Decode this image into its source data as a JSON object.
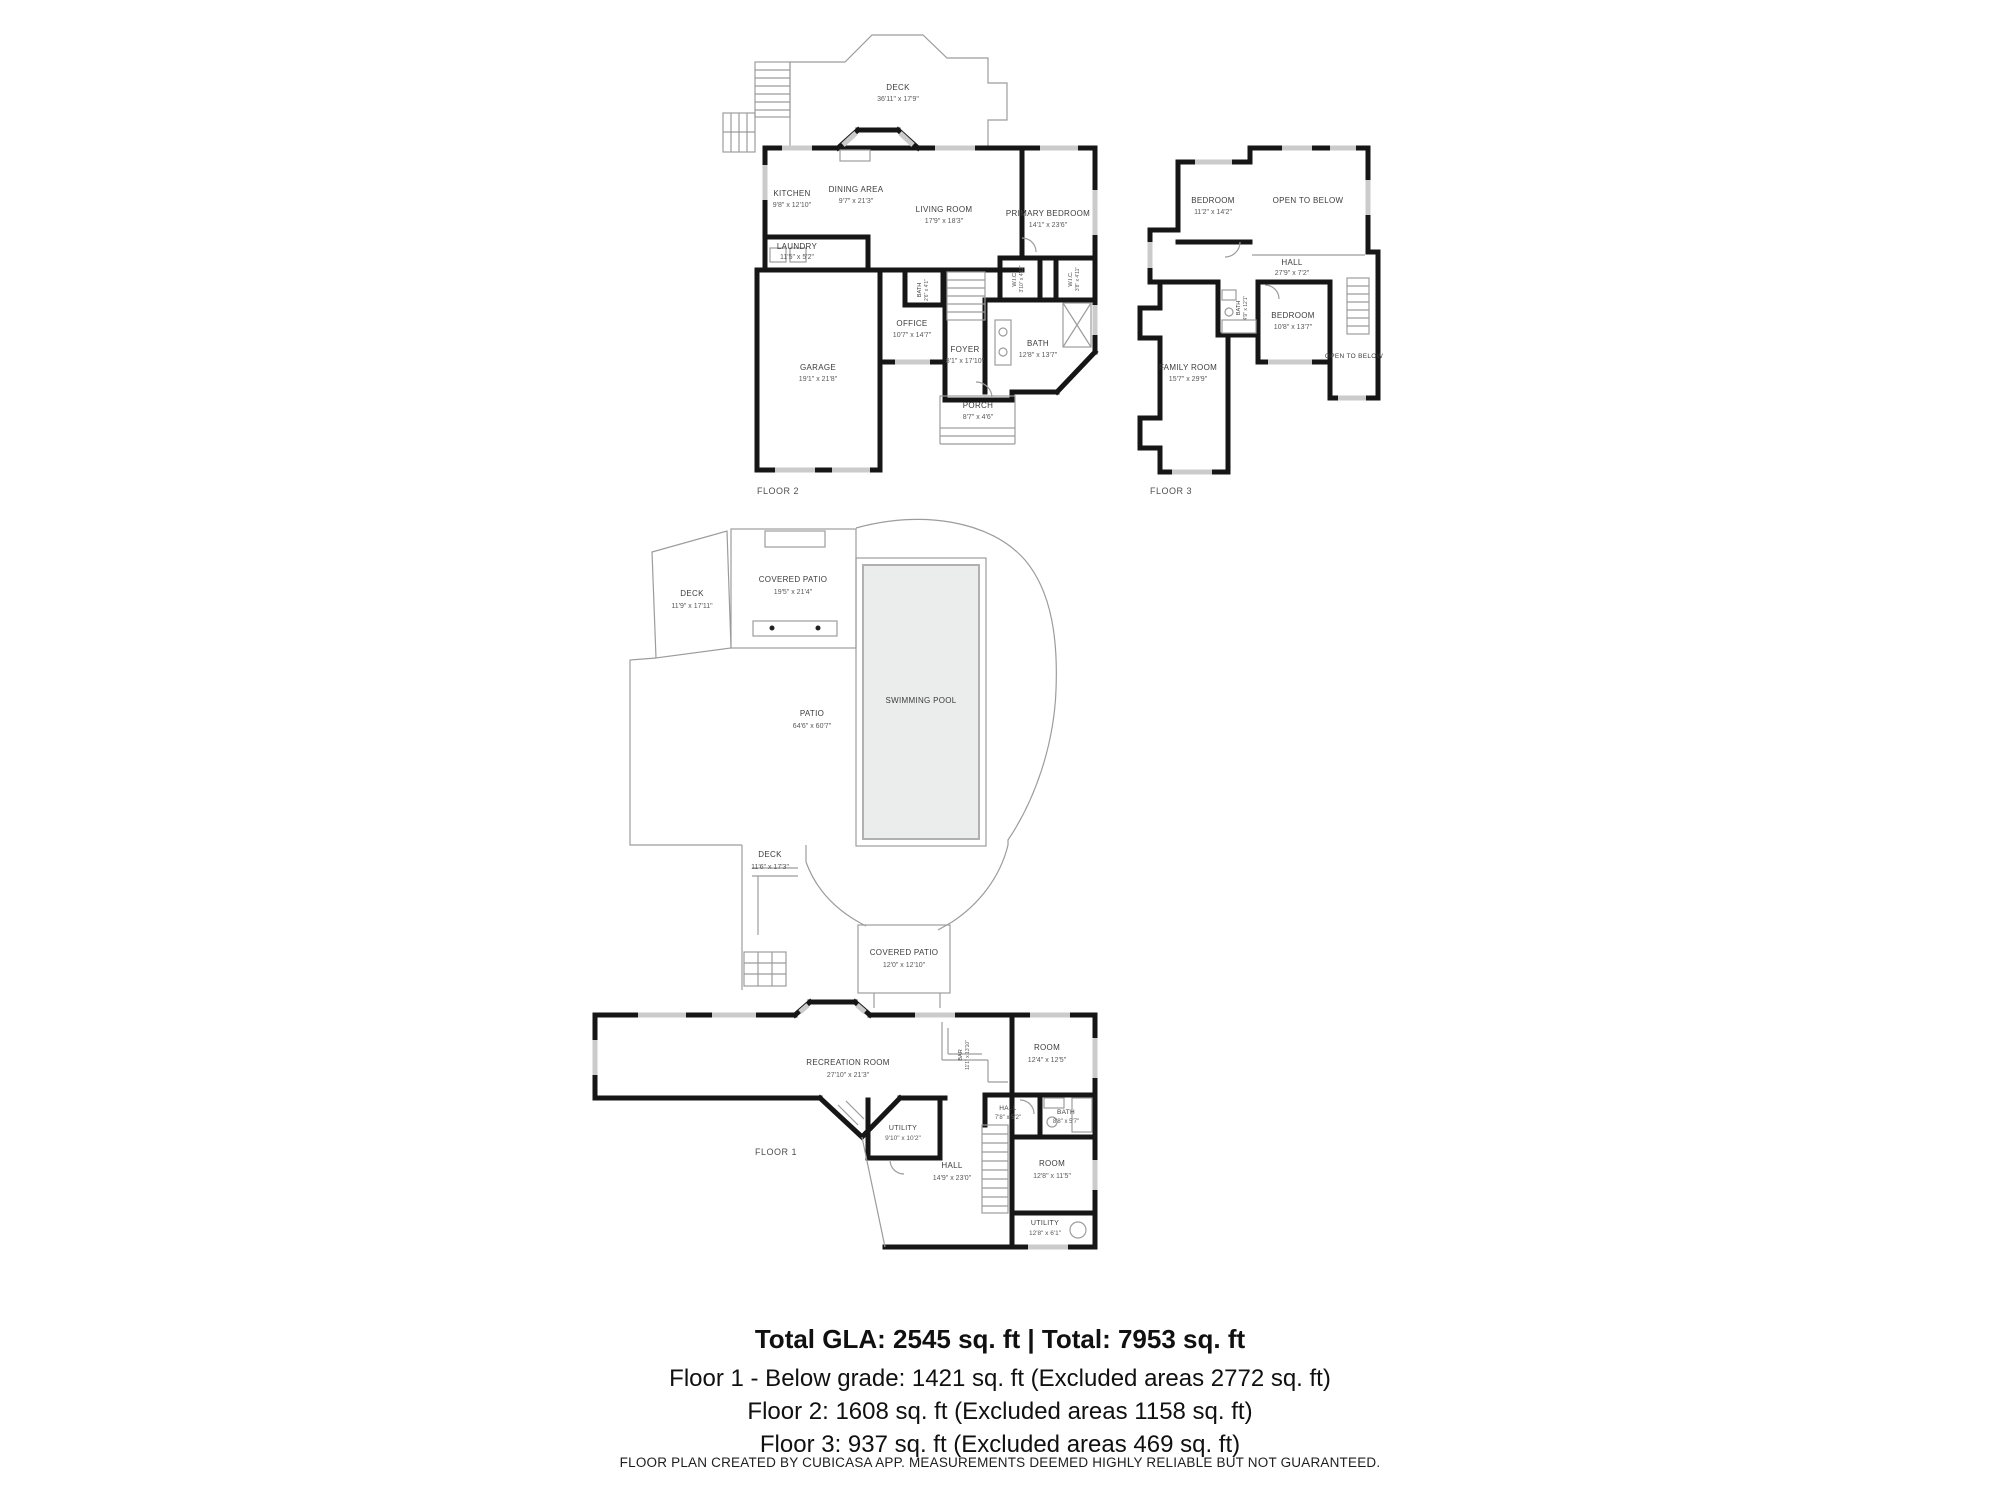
{
  "floor2": {
    "floor_label": "FLOOR 2",
    "deck": {
      "name": "DECK",
      "dims": "36'11\" x 17'9\""
    },
    "kitchen": {
      "name": "KITCHEN",
      "dims": "9'8\" x 12'10\""
    },
    "dining": {
      "name": "DINING AREA",
      "dims": "9'7\" x 21'3\""
    },
    "living": {
      "name": "LIVING ROOM",
      "dims": "17'9\" x 18'3\""
    },
    "primary": {
      "name": "PRIMARY BEDROOM",
      "dims": "14'1\" x 23'6\""
    },
    "laundry": {
      "name": "LAUNDRY",
      "dims": "11'5\" x 5'2\""
    },
    "garage": {
      "name": "GARAGE",
      "dims": "19'1\" x 21'8\""
    },
    "office": {
      "name": "OFFICE",
      "dims": "10'7\" x 14'7\""
    },
    "foyer": {
      "name": "FOYER",
      "dims": "8'1\" x 17'10\""
    },
    "bath": {
      "name": "BATH",
      "dims": "12'8\" x 13'7\""
    },
    "smallbath": {
      "name": "BATH",
      "dims": "2'6\" x 4'1\""
    },
    "porch": {
      "name": "PORCH",
      "dims": "8'7\" x 4'6\""
    },
    "wic1": {
      "name": "W.I.C.",
      "dims": "3'10\" x 4'11\""
    },
    "wic2": {
      "name": "W.I.C.",
      "dims": "3'8\" x 4'11\""
    }
  },
  "floor3": {
    "floor_label": "FLOOR 3",
    "bedroom1": {
      "name": "BEDROOM",
      "dims": "11'2\" x 14'2\""
    },
    "open1": {
      "name": "OPEN TO BELOW"
    },
    "hall": {
      "name": "HALL",
      "dims": "27'9\" x 7'2\""
    },
    "bath": {
      "name": "BATH",
      "dims": "4'9\" x 12'1\""
    },
    "bedroom2": {
      "name": "BEDROOM",
      "dims": "10'8\" x 13'7\""
    },
    "open2": {
      "name": "OPEN TO BELOW"
    },
    "family": {
      "name": "FAMILY ROOM",
      "dims": "15'7\" x 29'9\""
    }
  },
  "site": {
    "deck_upper": {
      "name": "DECK",
      "dims": "11'9\" x 17'11\""
    },
    "covered_patio_upper": {
      "name": "COVERED PATIO",
      "dims": "19'5\" x 21'4\""
    },
    "patio": {
      "name": "PATIO",
      "dims": "64'6\" x 60'7\""
    },
    "pool": {
      "name": "SWIMMING POOL"
    },
    "deck_lower": {
      "name": "DECK",
      "dims": "11'6\" x 17'3\""
    },
    "covered_patio_lower": {
      "name": "COVERED PATIO",
      "dims": "12'0\" x 12'10\""
    }
  },
  "floor1": {
    "floor_label": "FLOOR 1",
    "recreation": {
      "name": "RECREATION ROOM",
      "dims": "27'10\" x 21'3\""
    },
    "bar": {
      "name": "BAR",
      "dims": "11'1\" x 13'10\""
    },
    "room1": {
      "name": "ROOM",
      "dims": "12'4\" x 12'5\""
    },
    "hall1": {
      "name": "HALL",
      "dims": "7'8\" x 5'2\""
    },
    "bath": {
      "name": "BATH",
      "dims": "8'8\" x 5'7\""
    },
    "utility1": {
      "name": "UTILITY",
      "dims": "9'10\" x 10'2\""
    },
    "hall2": {
      "name": "HALL",
      "dims": "14'9\" x 23'0\""
    },
    "room2": {
      "name": "ROOM",
      "dims": "12'8\" x 11'5\""
    },
    "utility2": {
      "name": "UTILITY",
      "dims": "12'8\" x 6'1\""
    }
  },
  "summary": {
    "total_line": "Total GLA: 2545 sq. ft | Total: 7953 sq. ft",
    "floor1_line": "Floor 1 - Below grade: 1421 sq. ft (Excluded areas 2772 sq. ft)",
    "floor2_line": "Floor 2: 1608 sq. ft (Excluded areas 1158 sq. ft)",
    "floor3_line": "Floor 3: 937 sq. ft (Excluded areas 469 sq. ft)",
    "disclaimer": "FLOOR PLAN CREATED BY CUBICASA APP. MEASUREMENTS DEEMED HIGHLY RELIABLE BUT NOT GUARANTEED."
  },
  "colors": {
    "wall": "#161616",
    "thin_line": "#9c9c9c",
    "window": "#cbcbcb",
    "pool_fill": "#ebecec",
    "label_text": "#3c3c3c"
  }
}
